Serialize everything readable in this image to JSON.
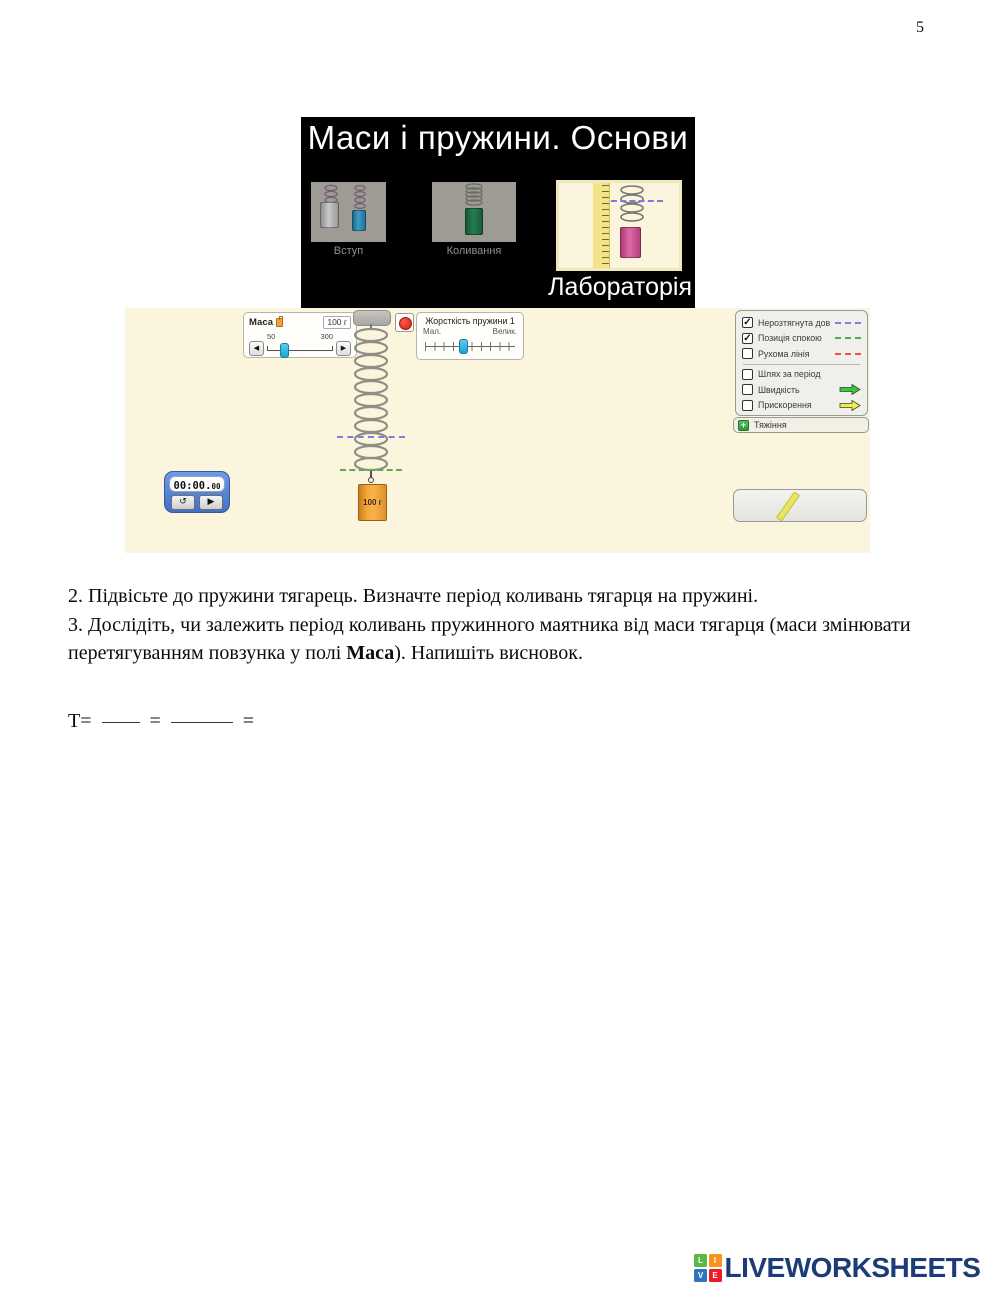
{
  "page": {
    "number": "5"
  },
  "sim": {
    "title": "Маси і пружини. Основи",
    "tabs": {
      "intro": "Вступ",
      "oscillation": "Коливання",
      "lab": "Лабораторія"
    },
    "mass_panel": {
      "label": "Маса",
      "value": "100 г",
      "min": "50",
      "max": "300"
    },
    "stiffness_panel": {
      "title": "Жорсткість пружини 1",
      "min_label": "Мал.",
      "max_label": "Велик."
    },
    "weight_label": "100 г",
    "timer": {
      "time_main": "00:00.",
      "time_frac": "00",
      "reset_icon": "↺",
      "play_icon": "▶"
    },
    "options": [
      {
        "label": "Нерозтягнута довжина",
        "check": "✓",
        "indicator": "dash",
        "color": "#8080e0"
      },
      {
        "label": "Позиція спокою",
        "check": "✓",
        "indicator": "dash",
        "color": "#45b049"
      },
      {
        "label": "Рухома лінія",
        "check": "",
        "indicator": "dash",
        "color": "#ef4f4f"
      },
      {
        "label": "Шлях за період",
        "check": "",
        "indicator": "none",
        "color": ""
      },
      {
        "label": "Швидкість",
        "check": "",
        "indicator": "arrow",
        "color": "#35cb35"
      },
      {
        "label": "Прискорення",
        "check": "",
        "indicator": "arrow",
        "color": "#f2ee44"
      }
    ],
    "gravity_bar": {
      "expander": "+",
      "label": "Тяжіння"
    }
  },
  "instructions": {
    "item2": "2. Підвісьте до пружини тягарець. Визначте період коливань тягарця на пружині.",
    "item3_pre": "3. Дослідіть, чи залежить період коливань пружинного маятника від маси тягарця (маси змінювати перетягуванням повзунка у полі ",
    "item3_bold": "Маса",
    "item3_post": "). Напишіть висновок.",
    "formula": {
      "t": "Т=",
      "eq1": "=",
      "eq2": "="
    }
  },
  "footer": {
    "logo_text": "LIVEWORKSHEETS",
    "logo_cells": [
      {
        "letter": "L",
        "color": "#58b947"
      },
      {
        "letter": "I",
        "color": "#f7941d"
      },
      {
        "letter": "V",
        "color": "#2e75bb"
      },
      {
        "letter": "E",
        "color": "#ed1c24"
      }
    ]
  }
}
